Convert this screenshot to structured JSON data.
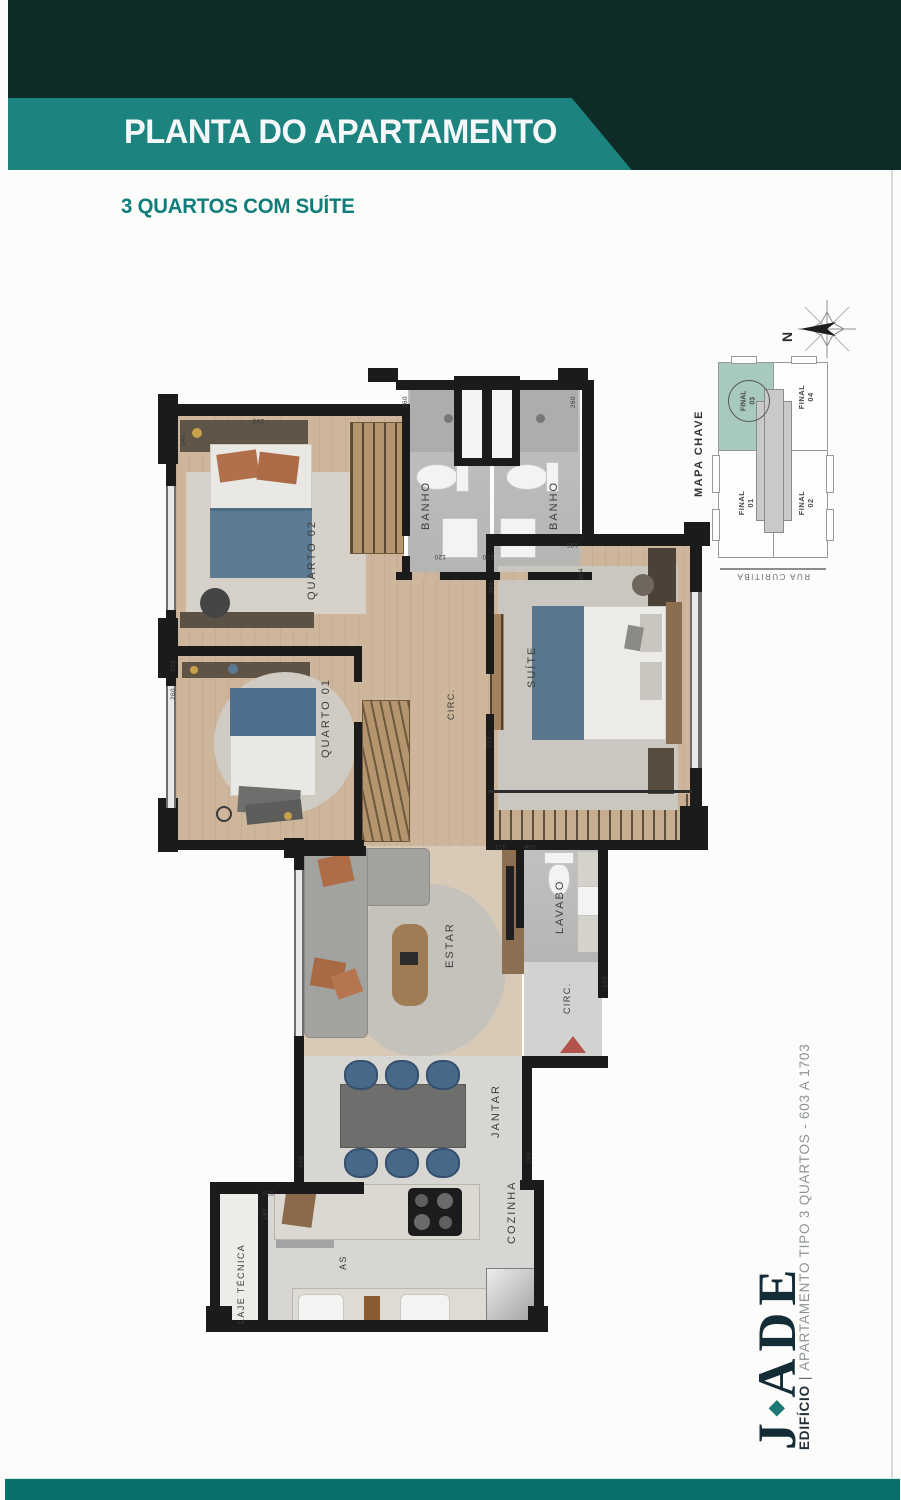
{
  "header": {
    "title": "PLANTA DO APARTAMENTO",
    "subtitle": "3 QUARTOS COM SUÍTE"
  },
  "colors": {
    "header_dark": "#0e2b27",
    "banner_teal": "#1d837f",
    "subtitle_teal": "#0f7d7a",
    "footer_teal": "#0a6f6b",
    "wall_black": "#1b1b1b",
    "highlight_unit": "#a7c9c0",
    "entrance_arrow": "#b2544b",
    "logo_navy": "#132c35",
    "logo_diamond_teal": "#1c7a72"
  },
  "plan": {
    "rooms": {
      "quarto02": "QUARTO 02",
      "banho1": "BANHO",
      "banho2": "BANHO",
      "suite": "SUÍTE",
      "quarto01": "QUARTO 01",
      "circ": "CIRC.",
      "estar": "ESTAR",
      "lavabo": "LAVABO",
      "circ2": "CIRC.",
      "jantar": "JANTAR",
      "cozinha": "COZINHA",
      "as": "AS",
      "laje": "LAJE TÉCNICA"
    },
    "dimensions": [
      "260",
      "260",
      "120",
      "120",
      "304",
      "135",
      "404",
      "275",
      "323",
      "260",
      "146",
      "290",
      "311",
      "166",
      "103",
      "452",
      "370",
      "197",
      "259"
    ]
  },
  "keymap": {
    "title": "MAPA CHAVE",
    "street": "RUA CURITIBA",
    "north": "N",
    "units": [
      {
        "label": "FINAL 03",
        "highlighted": true
      },
      {
        "label": "FINAL 04",
        "highlighted": false
      },
      {
        "label": "FINAL 01",
        "highlighted": false
      },
      {
        "label": "FINAL 02",
        "highlighted": false
      }
    ]
  },
  "brand": {
    "logo_j": "J",
    "logo_diamond": "◆",
    "logo_rest": "ADE",
    "building": "EDIFÍCIO",
    "separator": "|",
    "tagline": "APARTAMENTO TIPO 3 QUARTOS - 603 A 1703"
  }
}
